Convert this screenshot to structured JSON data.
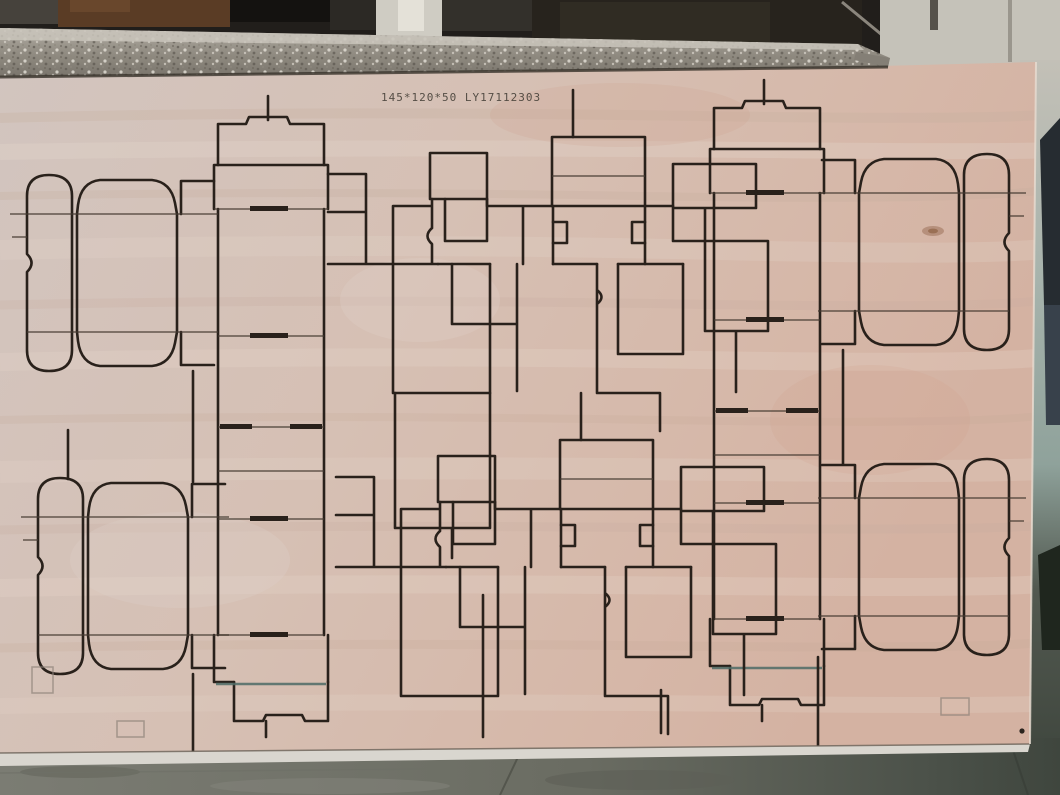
{
  "scene": {
    "type": "photograph",
    "subject": "Laser-engraved plywood die-cut board for folding carton boxes (tuck-end box blanks), leaning against a granite workbench edge in a workshop",
    "board": {
      "stamp_text": "145*120*50 LY17112303",
      "box_size_label": "145*120*50",
      "job_code": "LY17112303",
      "material": "plywood",
      "pattern": "two rows of mirrored tuck-end carton die lines with slots, notches and rounded dust flaps"
    },
    "colors": {
      "wood": "#d5bfb2",
      "wood_light": "#e0d2c9",
      "wood_dark": "#c0a899",
      "line": "#29211b",
      "crease": "#453a31",
      "slot": "#29211b",
      "teal_line": "#4e6b66",
      "granite": "#a8a399",
      "granite_dark": "#716c63",
      "granite_shadow": "#39342c",
      "bg_dark": "#211e1b",
      "wall": "#c3c0b7",
      "wall_teal": "#8fa29b",
      "dark_object": "#262c31",
      "floor": "#6a6c62",
      "floor_dark": "#434a41",
      "edge_light": "#d9d6cf",
      "stamp": "#4a443c"
    }
  }
}
